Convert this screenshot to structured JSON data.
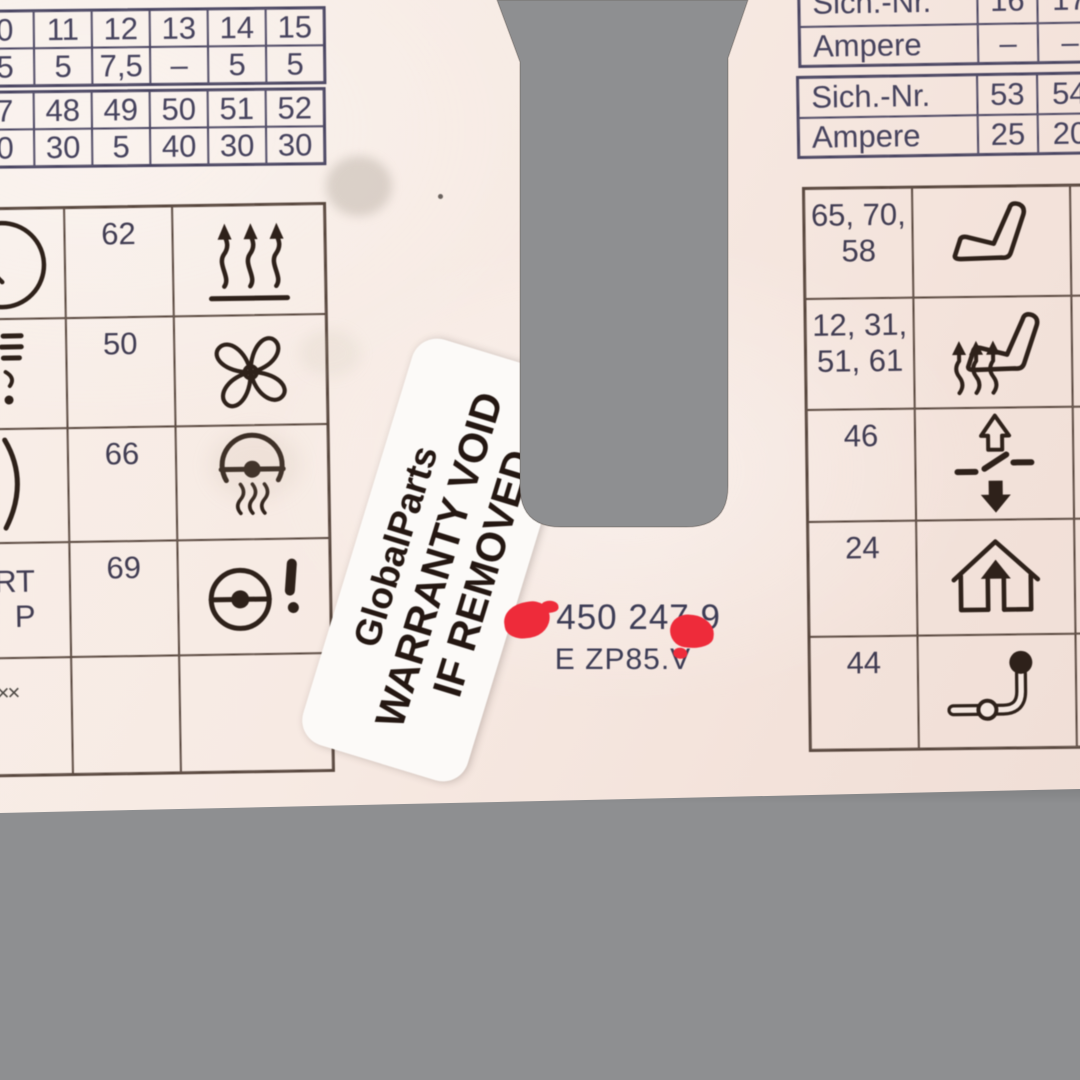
{
  "colors": {
    "background_gray": "#8e8f91",
    "card": "#f6ebe4",
    "table_line": "#474360",
    "grid_line": "#56453c",
    "number_text": "#403c52",
    "icon": "#2e211a",
    "sticker_text": "#241712",
    "red_mark": "#ee2b3a"
  },
  "top_left_tables": [
    {
      "rows": [
        [
          "0",
          "11",
          "12",
          "13",
          "14",
          "15"
        ],
        [
          "5",
          "5",
          "7,5",
          "–",
          "5",
          "5"
        ]
      ]
    },
    {
      "rows": [
        [
          "7",
          "48",
          "49",
          "50",
          "51",
          "52"
        ],
        [
          "0",
          "30",
          "5",
          "40",
          "30",
          "30"
        ]
      ]
    }
  ],
  "top_right_tables": [
    {
      "rows": [
        [
          "Sich.-Nr.",
          "16",
          "17"
        ],
        [
          "Ampere",
          "–",
          "–"
        ]
      ]
    },
    {
      "rows": [
        [
          "Sich.-Nr.",
          "53",
          "54"
        ],
        [
          "Ampere",
          "25",
          "20"
        ]
      ]
    }
  ],
  "left_grid": {
    "rows": [
      {
        "fuse": "62",
        "icon": "heater-airflow-icon"
      },
      {
        "fuse": "50",
        "icon": "fan-icon"
      },
      {
        "fuse": "66",
        "icon": "heated-steering-wheel-icon"
      },
      {
        "fuse": "69",
        "icon": "power-steering-warning-icon"
      },
      {
        "fuse": "",
        "icon": ""
      }
    ],
    "edge_row4_line1": "RT",
    "edge_row4_line2": "P",
    "edge_row5": "××"
  },
  "right_grid": {
    "rows": [
      {
        "fuse_lines": [
          "65, 70,",
          "58"
        ],
        "icon": "seat-icon",
        "sliver_lines": [
          "2"
        ]
      },
      {
        "fuse_lines": [
          "12, 31,",
          "51, 61"
        ],
        "icon": "heated-seat-icon",
        "sliver_lines": [
          "2",
          "2"
        ]
      },
      {
        "fuse_lines": [
          "46"
        ],
        "icon": "window-lifter-icon",
        "sliver_lines": []
      },
      {
        "fuse_lines": [
          "24"
        ],
        "icon": "sunroof-garage-icon",
        "sliver_lines": []
      },
      {
        "fuse_lines": [
          "44"
        ],
        "icon": "trailer-hitch-icon",
        "sliver_lines": []
      }
    ]
  },
  "sticker": {
    "line1": "GlobalParts",
    "line2": "WARRANTY VOID",
    "line3": "IF REMOVED"
  },
  "part_number": {
    "line1": "3 450 247 9",
    "line2": "E ZP85.V"
  }
}
